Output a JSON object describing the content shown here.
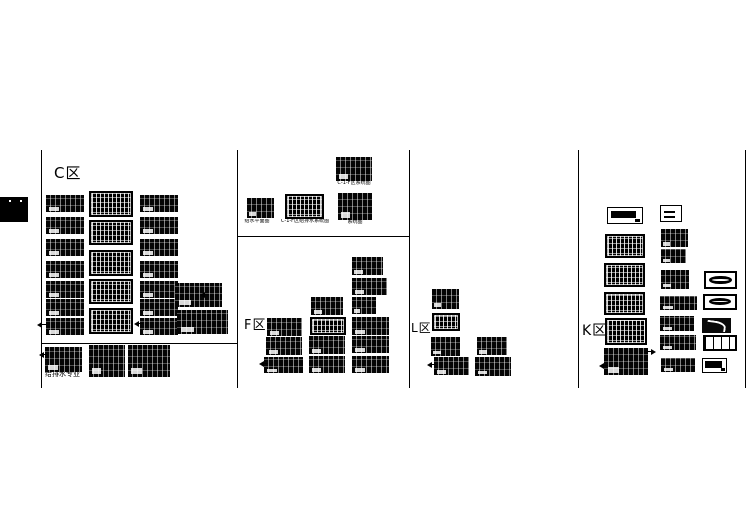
{
  "colors": {
    "background": "#ffffff",
    "ink": "#000000"
  },
  "sections": {
    "c": {
      "label": "C区",
      "sub_label": "给排水专业"
    },
    "f": {
      "label": "F区"
    },
    "l": {
      "label": "L区"
    },
    "k": {
      "label": "K区"
    }
  },
  "captions": {
    "top": "C-1-F区系统图",
    "row": [
      "给水平面图",
      "C-1-F区给排水系统图",
      "系统图"
    ]
  }
}
